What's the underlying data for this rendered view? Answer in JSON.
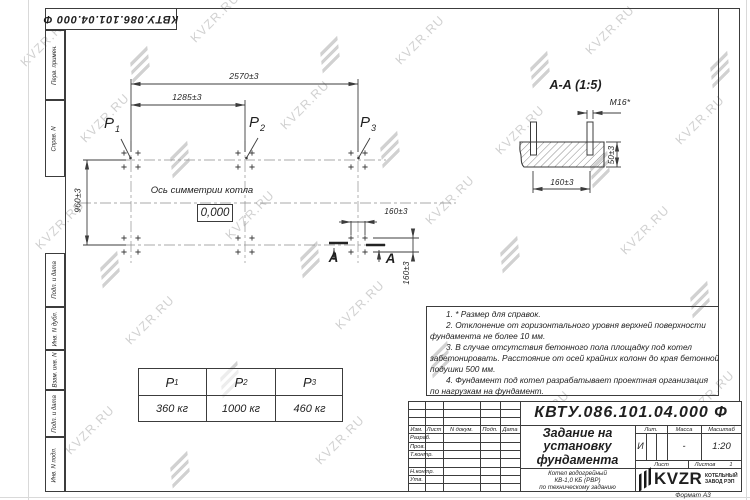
{
  "colors": {
    "ink": "#3c3c3c",
    "watermark": "#c9c9c9"
  },
  "watermark": {
    "text": "KVZR.RU"
  },
  "corner_stamp": {
    "doc_number": "КВТУ.086.101.04.000  Ф"
  },
  "side_strip": {
    "labels": [
      "Перв. примен.",
      "Справ. N",
      "Подп. и дата",
      "Инв. N дубл.",
      "Взам. инв. N",
      "Подп. и дата",
      "Инв. N подл."
    ]
  },
  "plan": {
    "dim_width_full": "2570±3",
    "dim_width_half": "1285±3",
    "dim_depth": "960±3",
    "dim_bolt_horizontal": "160±3",
    "dim_bolt_vertical": "160±3",
    "axis_label": "Ось симметрии котла",
    "level_mark": "0,000",
    "loads": [
      {
        "sym": "P",
        "sub": "1"
      },
      {
        "sym": "P",
        "sub": "2"
      },
      {
        "sym": "P",
        "sub": "3"
      }
    ],
    "section_letter": "А"
  },
  "section_view": {
    "title": "А-А (1:5)",
    "bolt_thread": "М16*",
    "dim_height": "50±3",
    "dim_spacing": "160±3"
  },
  "loads_table": {
    "columns": [
      {
        "sym": "P",
        "sub": "1",
        "value": "360 кг"
      },
      {
        "sym": "P",
        "sub": "2",
        "value": "1000 кг"
      },
      {
        "sym": "P",
        "sub": "3",
        "value": "460 кг"
      }
    ]
  },
  "notes": {
    "lines": [
      "1. * Размер для справок.",
      "2. Отклонение от горизонтального уровня верхней поверхности",
      "фундамента не более 10 мм.",
      "3. В случае отсутствия бетонного пола площадку под котел",
      "забетонировать. Расстояние от осей крайних колонн до края бетонной",
      "подушки 500 мм.",
      "4. Фундамент под котел разрабатывает проектная организация",
      "по нагрузкам на фундамент."
    ]
  },
  "title_block": {
    "doc_number": "КВТУ.086.101.04.000  Ф",
    "title_lines": [
      "Задание на",
      "установку",
      "фундамента"
    ],
    "product_lines": [
      "Котел водогрейный",
      "КВ-1,0 КБ (РВР)",
      "по техническому заданию"
    ],
    "change_header": [
      "Изм.",
      "Лист",
      "N докум.",
      "Подп.",
      "Дата"
    ],
    "signature_rows": [
      "Разраб.",
      "Пров.",
      "Т.контр.",
      "Н.контр.",
      "Утв."
    ],
    "lit_label": "Лит.",
    "mass_label": "Масса",
    "scale_label": "Масштаб",
    "lit_value": "И",
    "mass_value": "-",
    "scale_value": "1:20",
    "sheet_label": "Лист",
    "sheets_label": "Листов",
    "sheets_value": "1",
    "logo_text": "KVZR",
    "logo_caption": [
      "КОТЕЛЬНЫЙ",
      "ЗАВОД РЭП"
    ],
    "format_note": "Формат А3"
  }
}
